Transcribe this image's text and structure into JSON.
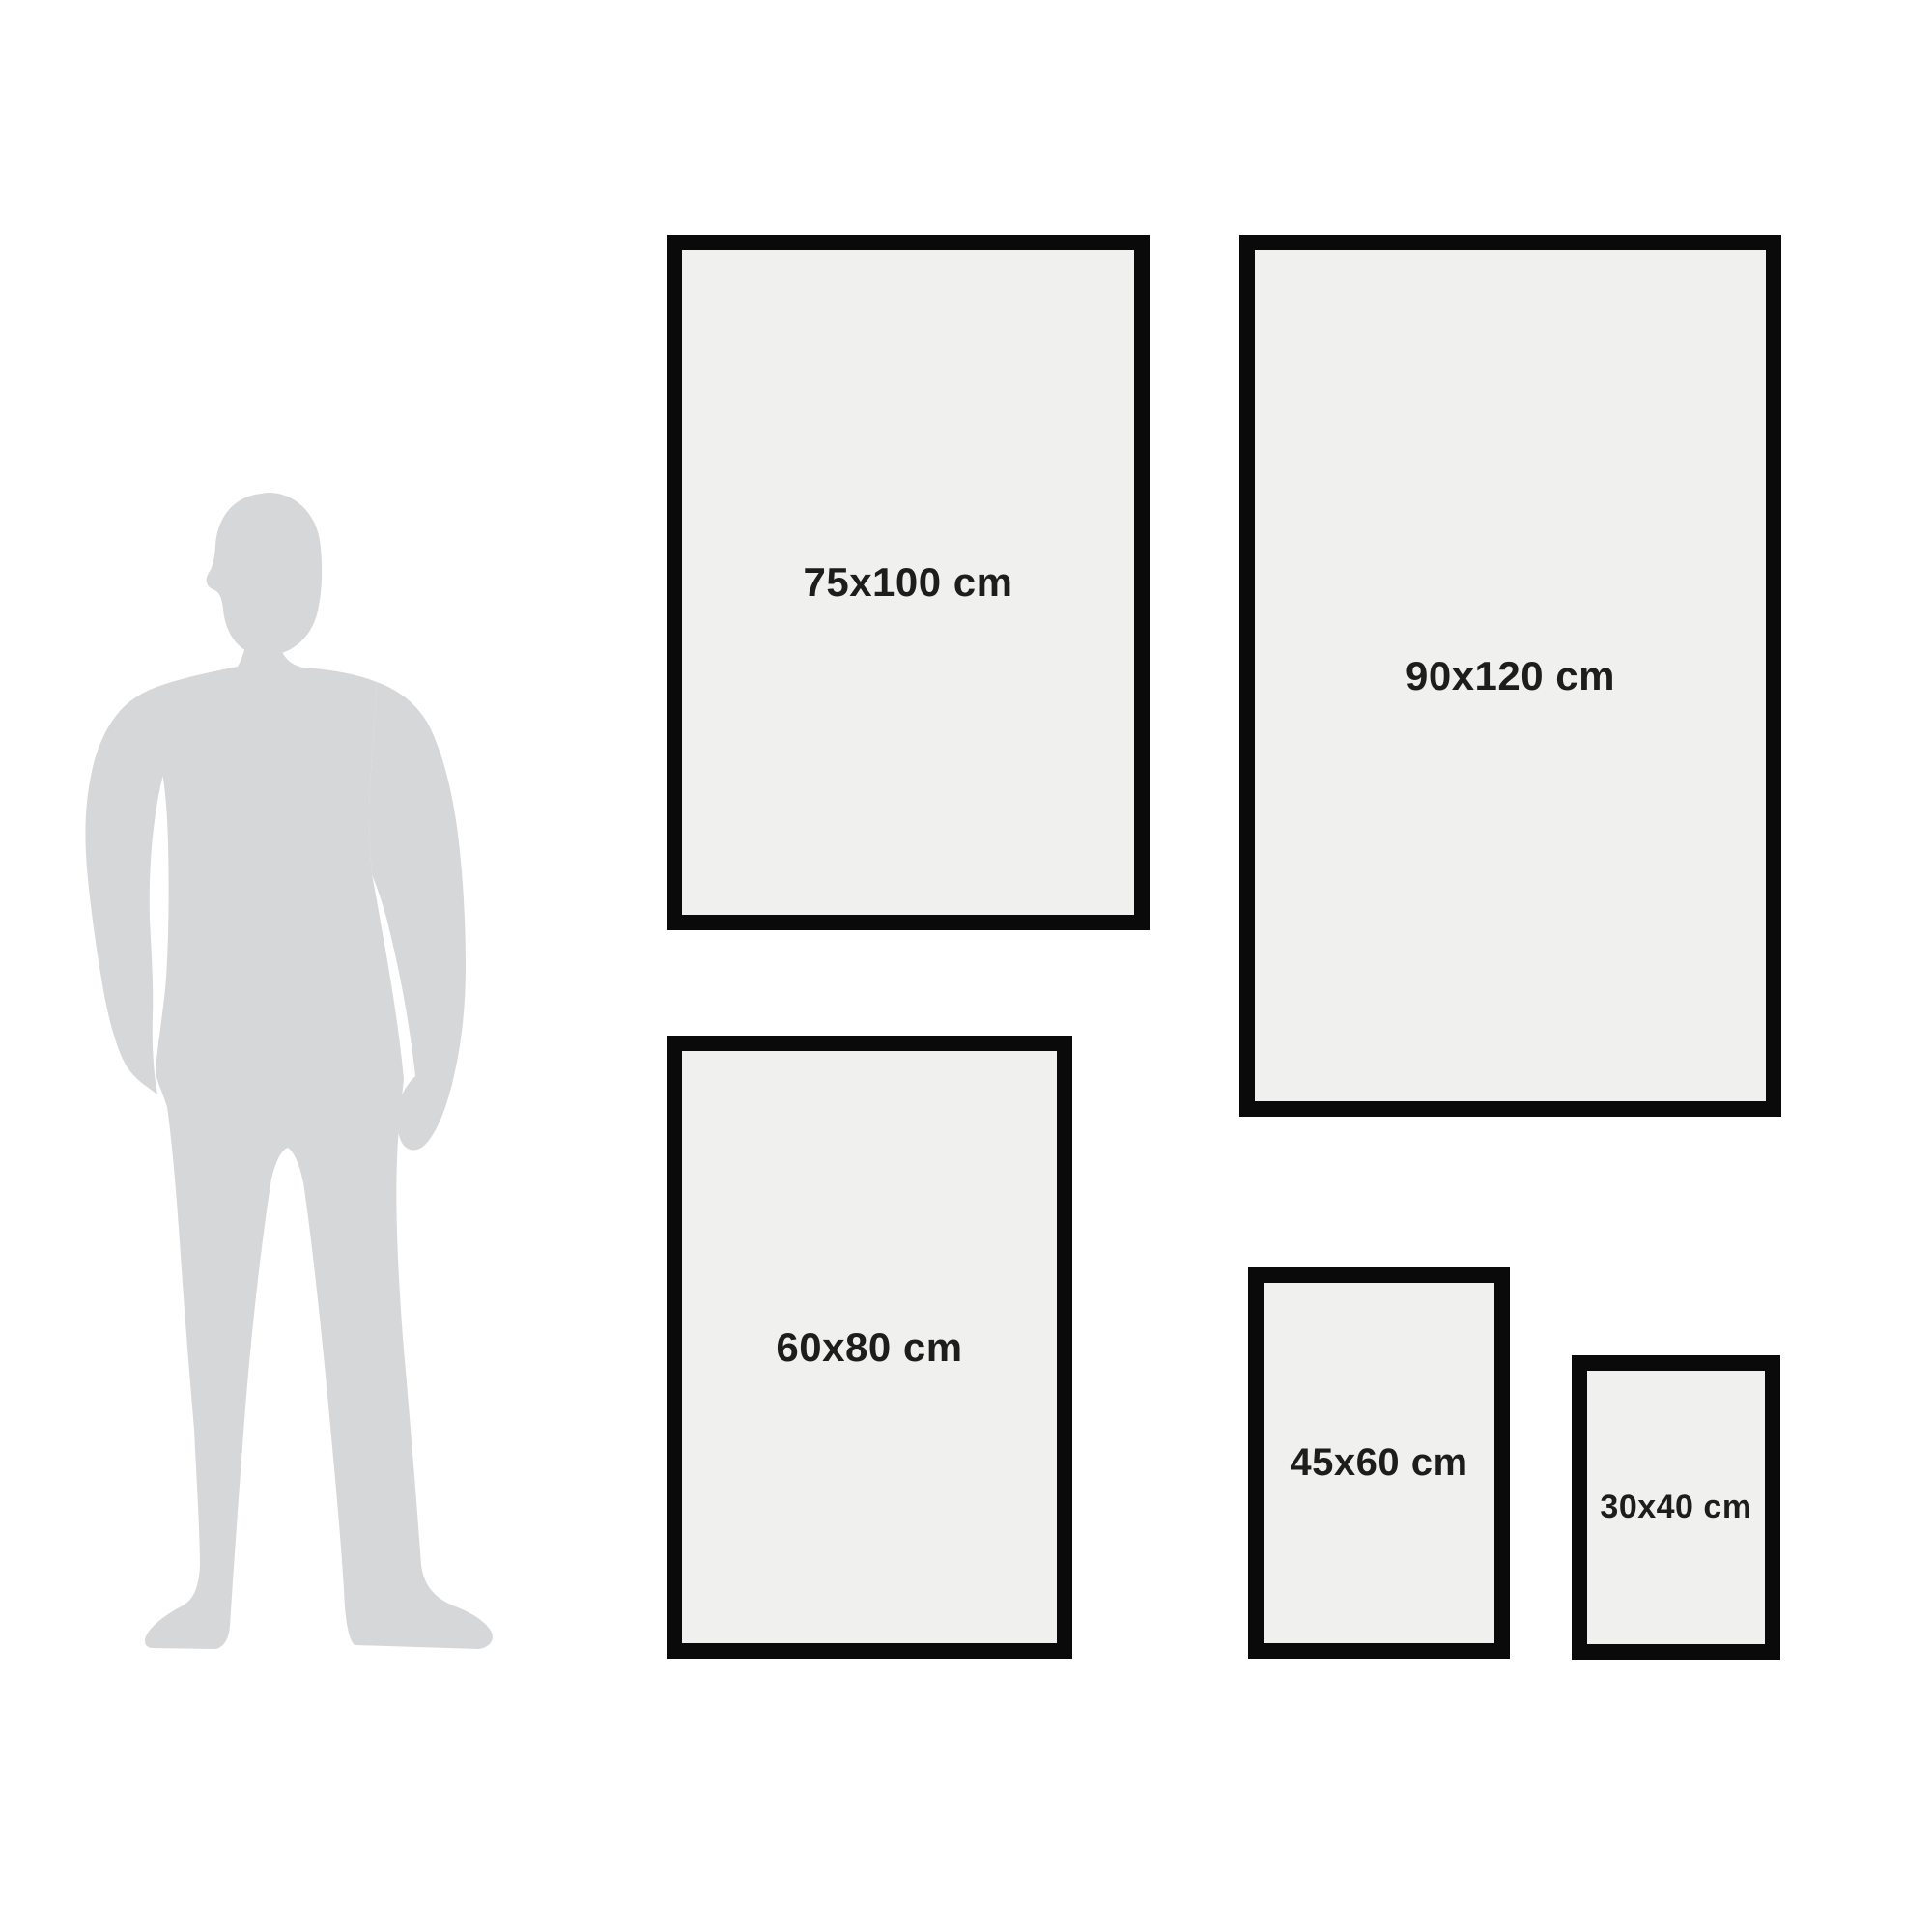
{
  "colors": {
    "background": "#ffffff",
    "frame_border": "#0a0a0a",
    "frame_fill": "#f0f0ee",
    "label_text": "#1d1d1d",
    "silhouette": "#d6d7d9"
  },
  "figure": {
    "icon": "standing-man-silhouette"
  },
  "frames": [
    {
      "id": "size-75x100",
      "label": "75x100 cm",
      "width_cm": 75,
      "height_cm": 100
    },
    {
      "id": "size-90x120",
      "label": "90x120 cm",
      "width_cm": 90,
      "height_cm": 120
    },
    {
      "id": "size-60x80",
      "label": "60x80 cm",
      "width_cm": 60,
      "height_cm": 80
    },
    {
      "id": "size-45x60",
      "label": "45x60 cm",
      "width_cm": 45,
      "height_cm": 60
    },
    {
      "id": "size-30x40",
      "label": "30x40 cm",
      "width_cm": 30,
      "height_cm": 40
    }
  ]
}
